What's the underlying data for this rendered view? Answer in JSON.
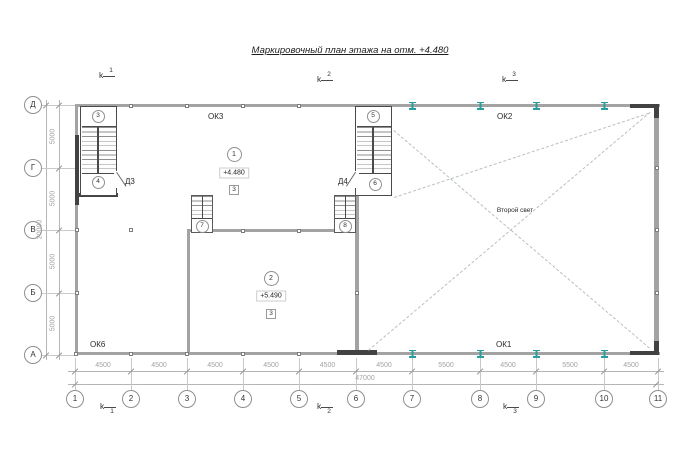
{
  "title": "Маркировочный план этажа на отм. +4.480",
  "section_marks": {
    "letter": "k",
    "numbers": [
      "1",
      "2",
      "3"
    ]
  },
  "axes": {
    "columns": [
      "1",
      "2",
      "3",
      "4",
      "5",
      "6",
      "7",
      "8",
      "9",
      "10",
      "11"
    ],
    "rows": [
      "Д",
      "Г",
      "В",
      "Б",
      "А"
    ]
  },
  "dimensions": {
    "bottom_spans": [
      "4500",
      "4500",
      "4500",
      "4500",
      "4500",
      "4500",
      "5500",
      "4500",
      "5500",
      "4500"
    ],
    "bottom_total": "47000",
    "left_spans": [
      "5000",
      "5000",
      "5000",
      "5000"
    ],
    "left_total": "20000"
  },
  "labels": {
    "ok3": "ОК3",
    "ok2": "ОК2",
    "ok1": "ОК1",
    "ok6": "ОК6",
    "d3": "Д3",
    "d4": "Д4",
    "second_light": "Второй свет"
  },
  "rooms": [
    {
      "number": "1",
      "elevation": "+4.480",
      "type_mark": "3"
    },
    {
      "number": "2",
      "elevation": "+5.490",
      "type_mark": "3"
    }
  ],
  "stair_marks": [
    "3",
    "4",
    "5",
    "6",
    "7",
    "8"
  ],
  "colors": {
    "steel_column": "#2a9d9d",
    "wall": "#a3a3a3",
    "dark_wall": "#424242",
    "dim": "#a3a3a3"
  }
}
